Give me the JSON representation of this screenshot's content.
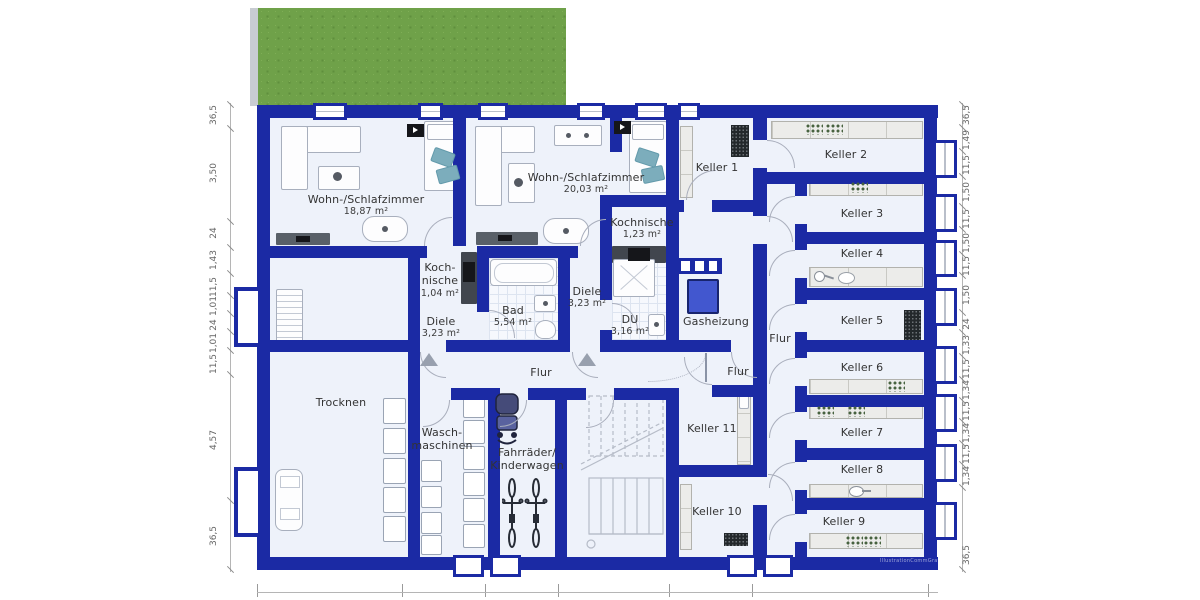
{
  "labels": {
    "wohn1_name": "Wohn-/Schlafzimmer",
    "wohn1_area": "18,87 m²",
    "wohn2_name": "Wohn-/Schlafzimmer",
    "wohn2_area": "20,03 m²",
    "koch1_l1": "Koch-",
    "koch1_l2": "nische",
    "koch1_area": "1,04 m²",
    "koch2_name": "Kochnische",
    "koch2_area": "1,23 m²",
    "bad_name": "Bad",
    "bad_area": "5,54 m²",
    "diele1_name": "Diele",
    "diele1_area": "3,23 m²",
    "diele2_name": "Diele",
    "diele2_area": "3,23 m²",
    "du_name": "DU",
    "du_area": "3,16 m²",
    "gasheizung": "Gasheizung",
    "trocknen": "Trocknen",
    "wasch_l1": "Wasch-",
    "wasch_l2": "maschinen",
    "fahrrad_l1": "Fahrräder/",
    "fahrrad_l2": "Kinderwagen",
    "flur_mid": "Flur",
    "flur_klein": "Flur",
    "flur_rechts": "Flur",
    "keller1": "Keller 1",
    "keller2": "Keller 2",
    "keller3": "Keller 3",
    "keller4": "Keller 4",
    "keller5": "Keller 5",
    "keller6": "Keller 6",
    "keller7": "Keller 7",
    "keller8": "Keller 8",
    "keller9": "Keller 9",
    "keller10": "Keller 10",
    "keller11": "Keller 11",
    "watermark": "IllustrationCommGrafik"
  },
  "dims": {
    "left": [
      "36,5",
      "3,50",
      "24",
      "1,43",
      "11,5",
      "1,01",
      "24",
      "1,01",
      "11,5",
      "4,57",
      "36,5"
    ],
    "right": [
      "36,5",
      "1,49",
      "11,5",
      "1,50",
      "11,5",
      "1,50",
      "11,5",
      "1,50",
      "24",
      "1,33",
      "11,5",
      "1,34",
      "11,5",
      "1,34",
      "11,5",
      "1,34",
      "36,5"
    ]
  },
  "colors": {
    "wall": "#1b2aa4",
    "floor": "#eef2fa",
    "grass": "#6fa149",
    "boiler": "#4257cf",
    "pillow": "#7cadbc",
    "label": "#333333"
  }
}
